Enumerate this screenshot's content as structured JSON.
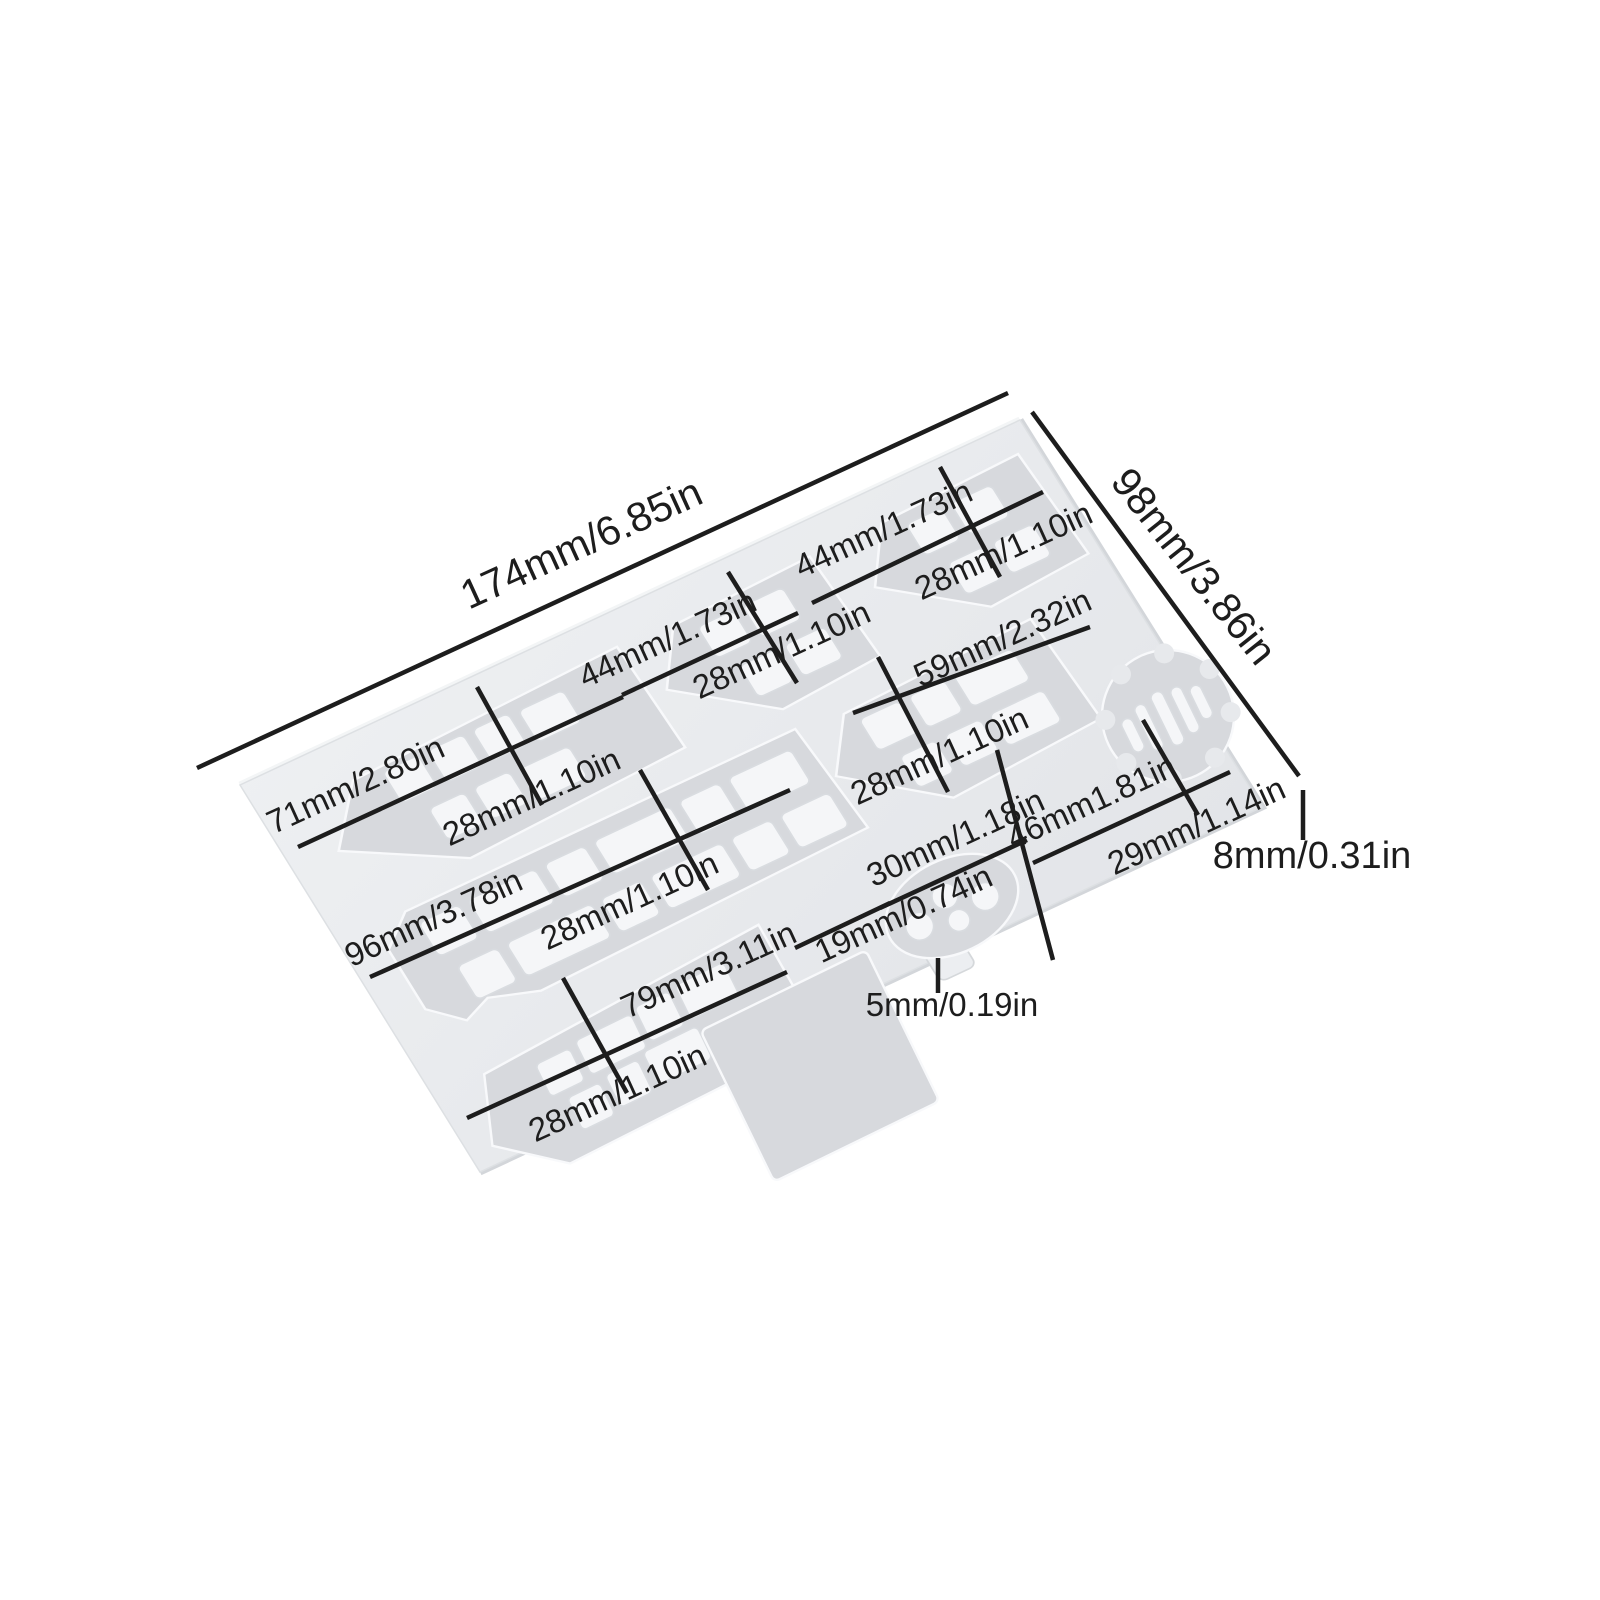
{
  "diagram": {
    "type": "product-dimension-diagram",
    "subject": "silicone mold plate with boat, train, gear and flower shaped cavities"
  },
  "colors": {
    "background": "#ffffff",
    "plate": "#e9ebee",
    "plate_edge_light": "#f3f5f6",
    "plate_edge_dark": "#d3d6da",
    "cavity": "#d7d9dd",
    "bump": "#f5f6f8",
    "annotation": "#1d1d1d"
  },
  "annotations": {
    "overall_width": "174mm/6.85in",
    "overall_depth": "98mm/3.86in",
    "overall_thickness": "8mm/0.31in",
    "cavity_71_width": "71mm/2.80in",
    "cavity_71_height": "28mm/1.10in",
    "cavity_44_mid_width": "44mm/1.73in",
    "cavity_44_mid_height": "28mm/1.10in",
    "cavity_44_right_width": "44mm/1.73in",
    "cavity_44_right_height": "28mm/1.10in",
    "cavity_59_width": "59mm/2.32in",
    "cavity_59_height": "28mm/1.10in",
    "cavity_96_width": "96mm/3.78in",
    "cavity_96_height": "28mm/1.10in",
    "cavity_79_width": "79mm/3.11in",
    "cavity_79_height": "28mm/1.10in",
    "flower_width": "30mm/1.18in",
    "flower_height": "19mm/0.74in",
    "tab_size": "5mm/0.19in",
    "gear_width": "46mm1.81in",
    "gear_height": "29mm/1.14in"
  }
}
